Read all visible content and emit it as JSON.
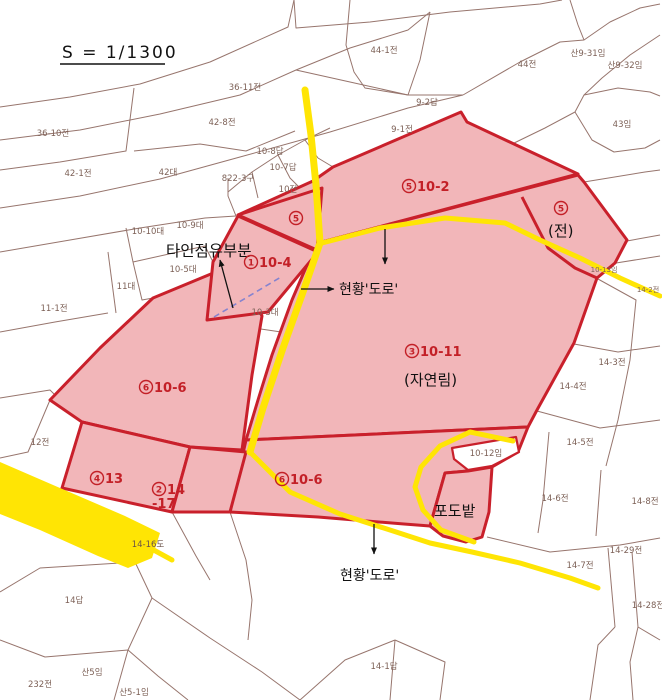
{
  "scale": {
    "label": "S = 1/1300"
  },
  "colors": {
    "highlight_fill": "#f2b6b9",
    "highlight_stroke": "#c9202b",
    "road": "#ffe504",
    "mesh_line": "#97756d",
    "red_label": "#c32027",
    "dashed_boundary": "#8583cf"
  },
  "annotations": {
    "occupied_by_others": "타인점유부분",
    "road_status_top": "현황'도로'",
    "road_status_bottom": "현황'도로'",
    "natural_forest": "(자연림)",
    "field": "(전)",
    "vineyard": "포도밭"
  },
  "red_parcels": {
    "p10_2": {
      "no": "5",
      "lot": "10-2"
    },
    "p10_4": {
      "no": "1",
      "lot": "10-4"
    },
    "p10_11": {
      "no": "3",
      "lot": "10-11"
    },
    "p10_6_upper": {
      "no": "6",
      "lot": "10-6"
    },
    "p13": {
      "no": "4",
      "lot": "13"
    },
    "p14_17": {
      "no": "2",
      "lot": "14",
      "lot2": "-17"
    },
    "p10_6_lower": {
      "no": "6",
      "lot": "10-6"
    },
    "tri": {
      "no": "5"
    },
    "jeon": {
      "no": "5"
    }
  },
  "parcel_labels": [
    "36-10전",
    "42-1전",
    "42대",
    "822-3구",
    "42-8전",
    "36-11전",
    "10-8답",
    "10-7답",
    "10전",
    "44-1전",
    "44전",
    "산9-31임",
    "산9-32임",
    "43임",
    "9-2답",
    "9-1전",
    "10-9대",
    "10-10대",
    "10-5대",
    "11대",
    "11-1전",
    "10-3대",
    "12전",
    "14-16도",
    "14답",
    "10-12임",
    "14-3전",
    "14-4전",
    "14-5전",
    "14-6전",
    "14-8전",
    "14-29전",
    "14-7전",
    "14-28전",
    "232전",
    "산5임",
    "산5-1임",
    "14-1답",
    "10-13임",
    "14-2전"
  ]
}
